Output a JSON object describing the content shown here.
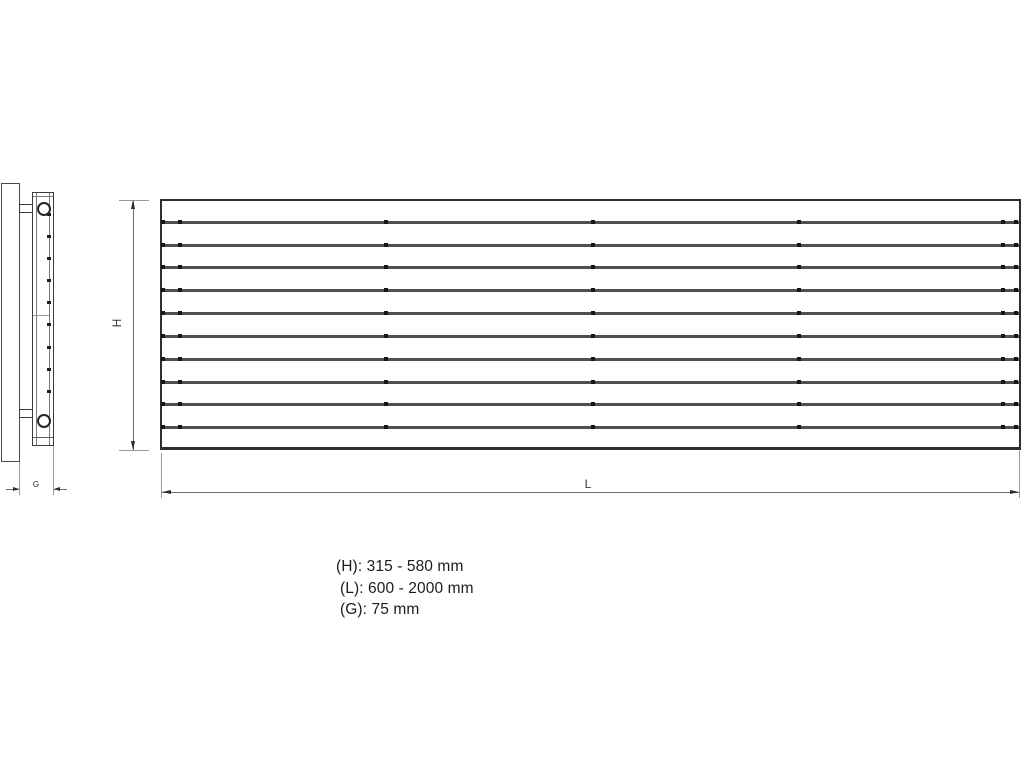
{
  "front_view": {
    "slat_count": 10,
    "dot_columns_x": [
      163,
      180,
      386,
      593,
      799,
      1003,
      1016
    ]
  },
  "side_view": {
    "slat_marks_y": [
      213,
      235,
      257,
      279,
      301,
      323,
      346,
      368,
      390
    ]
  },
  "dimension_labels": {
    "height": "H",
    "length": "L",
    "depth": "G"
  },
  "specs": {
    "height": "(H): 315 - 580 mm",
    "length": "(L): 600 - 2000 mm",
    "depth": "(G): 75 mm"
  },
  "colors": {
    "ink": "#2b2b2b",
    "slat_line": "#4f4f4f",
    "dimension_line": "#6e6e6e",
    "extension_line": "#9a9a9a",
    "background": "#ffffff"
  }
}
